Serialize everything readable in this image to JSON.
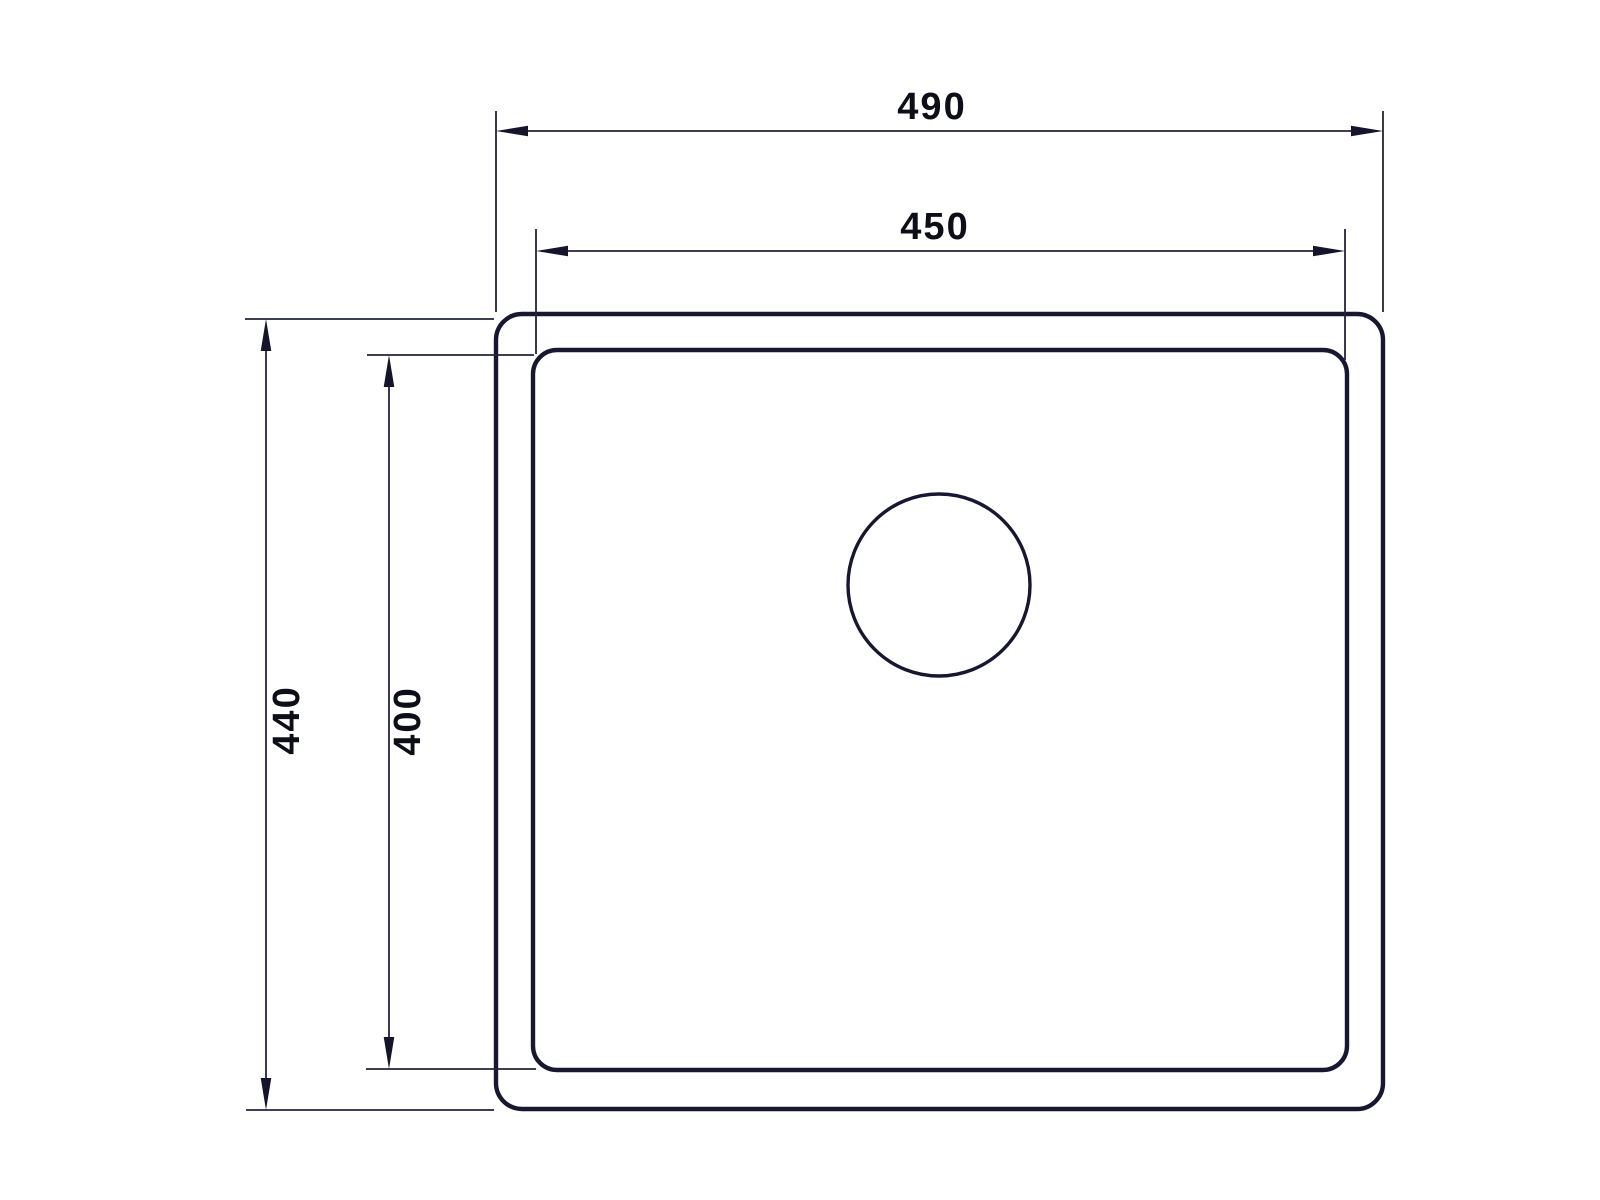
{
  "drawing": {
    "description": "Top-view technical line drawing of a rectangular sink with rounded corners, an inner basin outline and a circular drain, annotated with four linear dimensions",
    "background_color": "#ffffff",
    "line_color": "#1b1b33",
    "text_color": "#0e0e18"
  },
  "dimensions": [
    {
      "id": "outer-width",
      "value": "490",
      "orientation": "horizontal"
    },
    {
      "id": "inner-width",
      "value": "450",
      "orientation": "horizontal"
    },
    {
      "id": "outer-height",
      "value": "440",
      "orientation": "vertical"
    },
    {
      "id": "inner-height",
      "value": "400",
      "orientation": "vertical"
    }
  ]
}
